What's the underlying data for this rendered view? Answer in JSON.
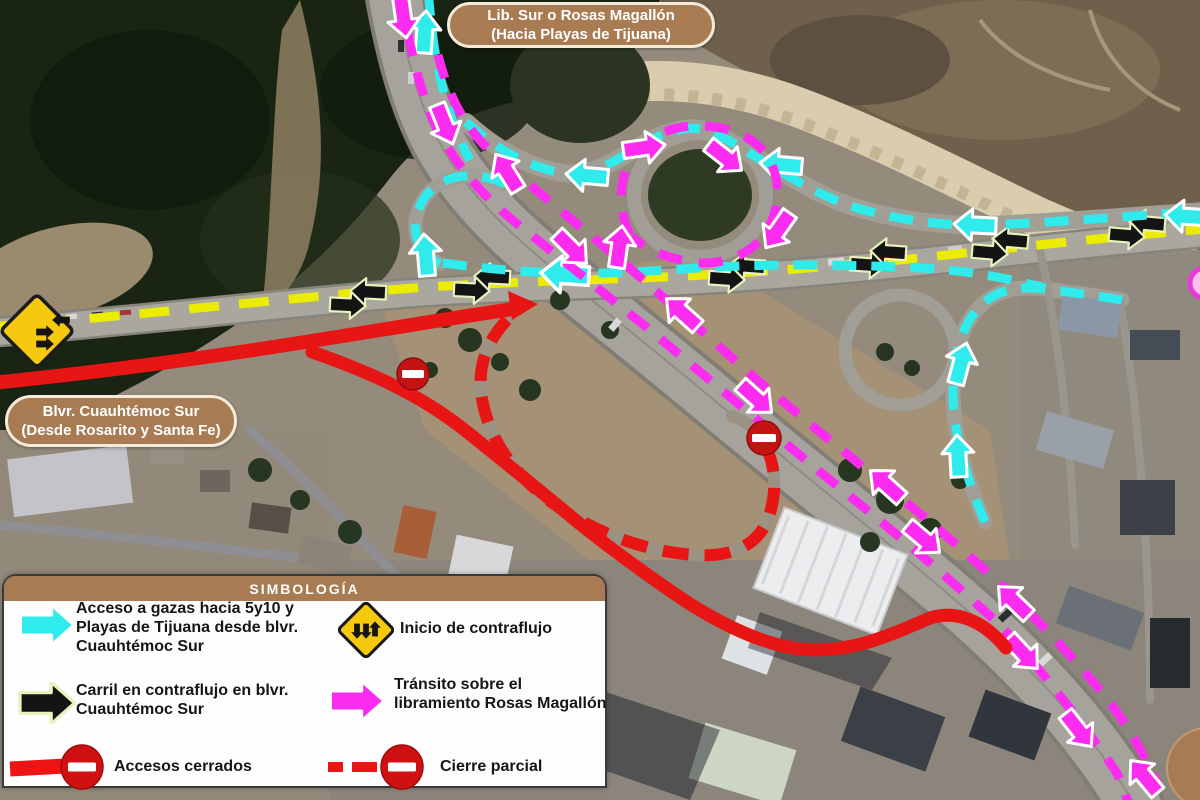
{
  "map": {
    "top_label": {
      "lines": [
        "Lib. Sur o Rosas Magallón",
        "(Hacia Playas de Tijuana)"
      ]
    },
    "left_label": {
      "lines": [
        "Blvr. Cuauhtémoc Sur",
        "(Desde Rosarito y Santa Fe)"
      ]
    },
    "routes": [
      {
        "name": "acceso-gazas",
        "color": "#30EBEB",
        "style": "dashed-arrows"
      },
      {
        "name": "contraflujo-cuauhtemoc",
        "color": "#ECEC00",
        "style": "dashed"
      },
      {
        "name": "carril-contraflujo-arrows",
        "color": "#141414",
        "style": "block-arrows"
      },
      {
        "name": "transito-libramiento",
        "color": "#FB2CF0",
        "style": "dashed-arrows"
      },
      {
        "name": "accesos-cerrados",
        "color": "#E81515",
        "style": "solid"
      },
      {
        "name": "cierre-parcial",
        "color": "#E81515",
        "style": "dashed"
      }
    ],
    "signs": [
      "no-entry-sign",
      "no-entry-sign",
      "two-way-contraflow-diamond-sign"
    ]
  },
  "legend": {
    "title": "SIMBOLOGÍA",
    "items": [
      {
        "icon": "cyan-arrow-icon",
        "color": "#30EBEB",
        "lines": [
          "Acceso a gazas hacia 5y10 y",
          "Playas de Tijuana desde blvr.",
          "Cuauhtémoc Sur"
        ]
      },
      {
        "icon": "contraflow-start-sign-icon",
        "color": "#F6C80E",
        "lines": [
          "Inicio de contraflujo"
        ]
      },
      {
        "icon": "black-arrow-icon",
        "color": "#141414",
        "lines": [
          "Carril en contraflujo en blvr.",
          "Cuauhtémoc Sur"
        ]
      },
      {
        "icon": "magenta-arrow-icon",
        "color": "#FB2CF0",
        "lines": [
          "Tránsito sobre el",
          "libramiento Rosas Magallón"
        ]
      },
      {
        "icon": "closed-access-icon",
        "color": "#E81515",
        "lines": [
          "Accesos cerrados"
        ]
      },
      {
        "icon": "partial-closure-icon",
        "color": "#E81515",
        "lines": [
          "Cierre parcial"
        ]
      }
    ]
  },
  "colors": {
    "label_brown": "#A87B52",
    "cyan": "#30EBEB",
    "magenta": "#FB2CF0",
    "yellow": "#ECEC00",
    "red": "#E81515",
    "no_entry_red": "#C41313",
    "sign_yellow": "#F6C80E"
  }
}
